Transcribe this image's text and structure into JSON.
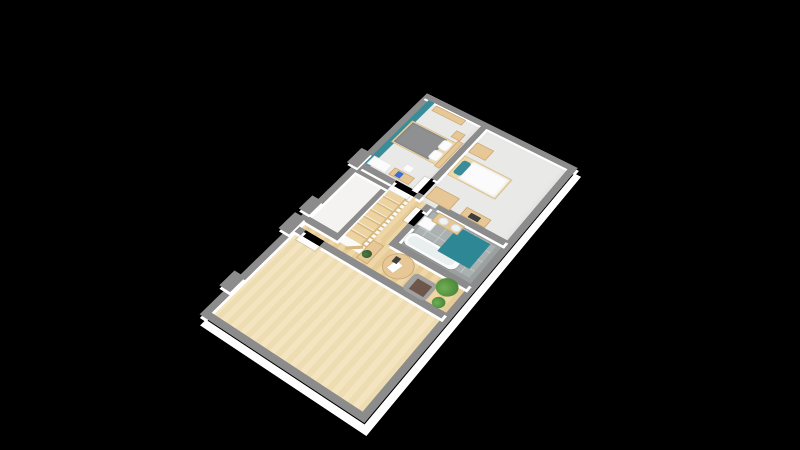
{
  "scene": {
    "type": "isometric-3d-floor-plan",
    "description": "3D rendered upper-floor apartment plan on black background, no visible text",
    "rooms": [
      "large-empty-room",
      "hallway-landing",
      "unfurnished-room",
      "staircase",
      "master-bedroom",
      "second-bedroom",
      "bathroom"
    ]
  },
  "palette": {
    "bg": "#000000",
    "wall": "#8c8c8c",
    "wallface": "#ffffff",
    "teal": "#3a8d98",
    "tealdark": "#2e8794",
    "woodbig1": "#f4e5c0",
    "woodbig2": "#eeddb2",
    "woodhall1": "#eed6a6",
    "woodhall2": "#e7cc97",
    "tilebase": "#abb1b0",
    "tilegrout": "#c6cac9",
    "tileborder": "#9ba1a0",
    "carpet": "#e9e9e7",
    "whitefloor": "#f4f3f1",
    "voidfloor": "#fafaf8",
    "wood": "#e6c795",
    "woodlight": "#eed7a8",
    "rail": "#d7b87f",
    "stair1": "#ecd3a0",
    "stair2": "#d9ba83",
    "duvet": "#8f9092",
    "bedwhite": "#fbfbfb",
    "white": "#fbfbfb",
    "doorleaf": "#fdfdfd",
    "chair": "#a1a19f",
    "brown": "#6e564a",
    "plant1": "#6fae54",
    "plant2": "#3f7a31",
    "plantd1": "#4c7d44",
    "plantd2": "#274d27",
    "blue": "#3a6fd4",
    "dark": "#3e3e3e",
    "paper": "#ffffff",
    "tubin": "#e9efef",
    "sink": "#eff3f3"
  },
  "elements": [
    {
      "n": "big-room-floor",
      "c": "wood-big",
      "x": 18,
      "y": 18,
      "w": 122,
      "h": 179
    },
    {
      "n": "hall-strip-floor",
      "c": "wood-hall",
      "x": 148,
      "y": 18,
      "w": 8,
      "h": 36
    },
    {
      "n": "hall-open-floor",
      "c": "wood-hall",
      "x": 148,
      "y": 54,
      "w": 34,
      "h": 143
    },
    {
      "n": "hall-corridor-floor",
      "c": "wood-hall",
      "x": 182,
      "y": 88,
      "w": 66,
      "h": 16
    },
    {
      "n": "unfurnished-room-floor",
      "c": "floor-white",
      "x": 156,
      "y": 18,
      "w": 92,
      "h": 42
    },
    {
      "n": "stairwell-void",
      "c": "floor-void",
      "x": 156,
      "y": 60,
      "w": 92,
      "h": 28
    },
    {
      "n": "master-bedroom-floor",
      "c": "carpet",
      "x": 256,
      "y": 18,
      "w": 119,
      "h": 70
    },
    {
      "n": "second-bedroom-floor",
      "c": "carpet",
      "x": 248,
      "y": 95,
      "w": 127,
      "h": 102
    },
    {
      "n": "bathroom-floor",
      "c": "tile",
      "x": 190,
      "y": 111,
      "w": 58,
      "h": 86
    },
    {
      "n": "exterior-wall-nw",
      "c": "wall-far",
      "x": 10,
      "y": 10,
      "w": 373,
      "h": 8
    },
    {
      "n": "exterior-wall-ne",
      "c": "wall-far",
      "x": 375,
      "y": 10,
      "w": 8,
      "h": 195
    },
    {
      "n": "exterior-wall-se",
      "c": "wall-near",
      "x": 10,
      "y": 197,
      "w": 373,
      "h": 8
    },
    {
      "n": "exterior-wall-sw",
      "c": "wall-near",
      "x": 10,
      "y": 10,
      "w": 8,
      "h": 195
    },
    {
      "n": "wall-jut-a",
      "c": "wall-far",
      "x": 46,
      "y": 2,
      "w": 22,
      "h": 14
    },
    {
      "n": "wall-jut-b",
      "c": "wall-far",
      "x": 134,
      "y": 2,
      "w": 26,
      "h": 14
    },
    {
      "n": "wall-jut-c",
      "c": "wall-far",
      "x": 166,
      "y": 2,
      "w": 22,
      "h": 14
    },
    {
      "n": "wall-jut-d",
      "c": "wall-far",
      "x": 246,
      "y": 2,
      "w": 26,
      "h": 14
    },
    {
      "n": "bigroom-partition-a",
      "c": "wall",
      "x": 140,
      "y": 18,
      "w": 8,
      "h": 8
    },
    {
      "n": "bigroom-partition-b",
      "c": "wall",
      "x": 140,
      "y": 50,
      "w": 8,
      "h": 147
    },
    {
      "n": "unfurnished-wall-sw",
      "c": "wall",
      "x": 156,
      "y": 18,
      "w": 8,
      "h": 36
    },
    {
      "n": "unfurnished-wall-se",
      "c": "wall",
      "x": 156,
      "y": 54,
      "w": 92,
      "h": 6
    },
    {
      "n": "unfurnished-wall-ne",
      "c": "wall",
      "x": 240,
      "y": 18,
      "w": 8,
      "h": 42
    },
    {
      "n": "master-wall-sw",
      "c": "wall",
      "x": 248,
      "y": 18,
      "w": 8,
      "h": 42
    },
    {
      "n": "bedroom-divider-a",
      "c": "wall",
      "x": 248,
      "y": 88,
      "w": 8,
      "h": 7
    },
    {
      "n": "bedroom-divider-b",
      "c": "wall",
      "x": 280,
      "y": 88,
      "w": 95,
      "h": 7
    },
    {
      "n": "second-bedroom-wall-sw",
      "c": "wall",
      "x": 248,
      "y": 115,
      "w": 8,
      "h": 82
    },
    {
      "n": "bathroom-wall-nw-a",
      "c": "wall",
      "x": 190,
      "y": 104,
      "w": 26,
      "h": 7
    },
    {
      "n": "bathroom-wall-nw-b",
      "c": "wall",
      "x": 238,
      "y": 104,
      "w": 10,
      "h": 7
    },
    {
      "n": "bathroom-wall-sw",
      "c": "wall",
      "x": 182,
      "y": 104,
      "w": 8,
      "h": 93
    },
    {
      "n": "master-teal-accent-wall",
      "c": "teal",
      "x": 256,
      "y": 18,
      "w": 119,
      "h": 8
    },
    {
      "n": "stair-treads",
      "c": "stairs",
      "x": 166,
      "y": 62,
      "w": 74,
      "h": 22
    },
    {
      "n": "stair-balustrade",
      "c": "rail",
      "x": 166,
      "y": 84,
      "w": 78,
      "h": 4
    },
    {
      "n": "stair-balustrade-corner",
      "c": "rail-v",
      "x": 157,
      "y": 70,
      "w": 4,
      "h": 18,
      "rot": -40
    },
    {
      "n": "door-big-room",
      "c": "doorleaf",
      "x": 133,
      "y": 26,
      "w": 7,
      "h": 24
    },
    {
      "n": "door-master-bedroom",
      "c": "doorleaf",
      "x": 241,
      "y": 60,
      "w": 7,
      "h": 24
    },
    {
      "n": "door-second-bedroom",
      "c": "doorleaf",
      "x": 254,
      "y": 81,
      "w": 24,
      "h": 7
    },
    {
      "n": "door-bathroom",
      "c": "doorleaf",
      "x": 216,
      "y": 98,
      "w": 22,
      "h": 6
    },
    {
      "n": "hall-bookcase",
      "c": "wood",
      "x": 150,
      "y": 88,
      "w": 28,
      "h": 14
    },
    {
      "n": "bookcase-plant",
      "c": "plant-dark",
      "x": 155,
      "y": 89,
      "w": 10,
      "h": 10
    },
    {
      "n": "hall-round-table",
      "c": "wood round",
      "x": 150,
      "y": 112,
      "w": 32,
      "h": 32
    },
    {
      "n": "table-papers",
      "c": "paper",
      "x": 157,
      "y": 121,
      "w": 13,
      "h": 9,
      "rot": 12
    },
    {
      "n": "table-tablet",
      "c": "dark",
      "x": 167,
      "y": 119,
      "w": 8,
      "h": 6
    },
    {
      "n": "hall-armchair",
      "c": "chair",
      "x": 146,
      "y": 146,
      "w": 24,
      "h": 27,
      "rad": 5
    },
    {
      "n": "armchair-throw",
      "c": "brown",
      "x": 150,
      "y": 152,
      "w": 15,
      "h": 17
    },
    {
      "n": "hall-plant-large",
      "c": "plant",
      "x": 162,
      "y": 170,
      "w": 22,
      "h": 22
    },
    {
      "n": "hall-plant-small",
      "c": "plant",
      "x": 147,
      "y": 178,
      "w": 13,
      "h": 13
    },
    {
      "n": "bathtub",
      "c": "tub-out",
      "x": 192,
      "y": 113,
      "w": 18,
      "h": 62,
      "rad": 7
    },
    {
      "n": "bathtub-basin",
      "c": "tub-in",
      "x": 195,
      "y": 116,
      "w": 12,
      "h": 54,
      "rad": 6
    },
    {
      "n": "shower-mat-teal",
      "c": "teal-dark",
      "x": 204,
      "y": 148,
      "w": 38,
      "h": 38
    },
    {
      "n": "bathroom-cabinet",
      "c": "white",
      "x": 220,
      "y": 112,
      "w": 14,
      "h": 16
    },
    {
      "n": "vanity-cabinet",
      "c": "wood",
      "x": 232,
      "y": 121,
      "w": 14,
      "h": 32
    },
    {
      "n": "vanity-sink-a",
      "c": "sink round",
      "x": 234,
      "y": 126,
      "w": 10,
      "h": 11
    },
    {
      "n": "vanity-sink-b",
      "c": "sink round",
      "x": 234,
      "y": 141,
      "w": 10,
      "h": 11
    },
    {
      "n": "master-wardrobe",
      "c": "white",
      "x": 257,
      "y": 20,
      "w": 14,
      "h": 24
    },
    {
      "n": "master-desk",
      "c": "wood",
      "x": 258,
      "y": 48,
      "w": 12,
      "h": 26
    },
    {
      "n": "master-laptop",
      "c": "blue",
      "x": 260,
      "y": 54,
      "w": 8,
      "h": 7
    },
    {
      "n": "master-desk-chair",
      "c": "white",
      "x": 272,
      "y": 55,
      "w": 10,
      "h": 11,
      "rad": 3
    },
    {
      "n": "master-bed-frame",
      "c": "wood-light",
      "x": 298,
      "y": 22,
      "w": 40,
      "h": 62
    },
    {
      "n": "master-bed-duvet",
      "c": "duvet",
      "x": 300,
      "y": 24,
      "w": 36,
      "h": 46
    },
    {
      "n": "master-pillow-a",
      "c": "pillow",
      "x": 302,
      "y": 67,
      "w": 15,
      "h": 12,
      "rad": 3
    },
    {
      "n": "master-pillow-b",
      "c": "pillow",
      "x": 320,
      "y": 67,
      "w": 15,
      "h": 12,
      "rad": 3
    },
    {
      "n": "master-headboard-shelf",
      "c": "wood",
      "x": 296,
      "y": 80,
      "w": 46,
      "h": 7
    },
    {
      "n": "master-nightstand",
      "c": "wood",
      "x": 342,
      "y": 70,
      "w": 12,
      "h": 12
    },
    {
      "n": "master-shelf-ne-wall",
      "c": "wood",
      "x": 363,
      "y": 30,
      "w": 10,
      "h": 40
    },
    {
      "n": "second-dresser",
      "c": "wood",
      "x": 254,
      "y": 98,
      "w": 20,
      "h": 30
    },
    {
      "n": "second-bed-frame",
      "c": "wood-light",
      "x": 294,
      "y": 98,
      "w": 34,
      "h": 60
    },
    {
      "n": "second-bed-duvet",
      "c": "bed-white",
      "x": 296,
      "y": 110,
      "w": 30,
      "h": 46
    },
    {
      "n": "second-bed-pillow-teal",
      "c": "teal",
      "x": 300,
      "y": 101,
      "w": 22,
      "h": 10,
      "rad": 3
    },
    {
      "n": "second-tall-dresser",
      "c": "wood",
      "x": 334,
      "y": 98,
      "w": 18,
      "h": 22
    },
    {
      "n": "second-desk",
      "c": "wood",
      "x": 256,
      "y": 140,
      "w": 13,
      "h": 30
    },
    {
      "n": "second-desk-items",
      "c": "dark",
      "x": 258,
      "y": 148,
      "w": 7,
      "h": 12
    }
  ]
}
